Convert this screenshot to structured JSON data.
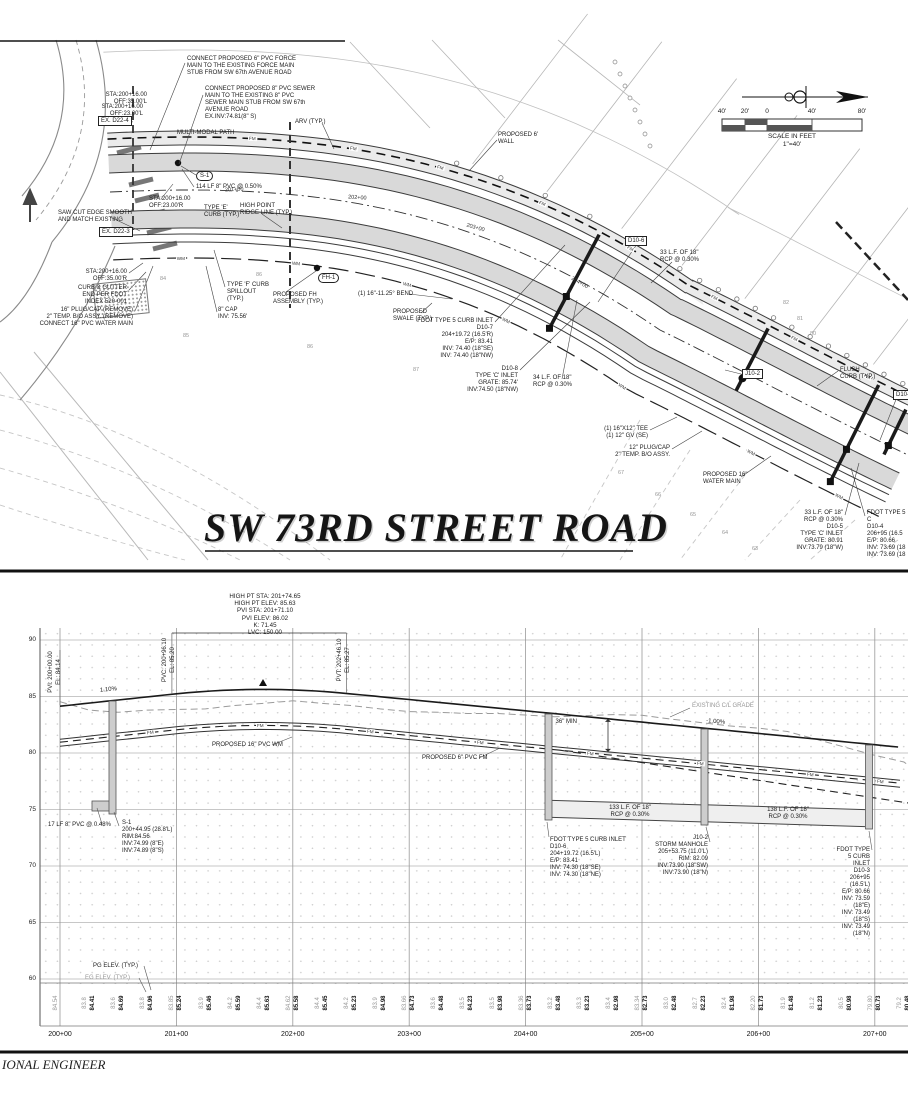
{
  "title": "SW 73RD STREET ROAD",
  "footer": "IONAL ENGINEER",
  "north_scale": {
    "ticks": [
      "40'",
      "20'",
      "0",
      "40'",
      "80'"
    ],
    "tick_x": [
      722,
      745,
      767,
      812,
      862
    ],
    "scale_label": "SCALE IN FEET",
    "scale_ratio": "1\"=40'"
  },
  "plan": {
    "labels": {
      "fm": "FM",
      "wm": "WM"
    },
    "fm_label_x": [
      250,
      340,
      430,
      520,
      600,
      688,
      768,
      842
    ],
    "wm_label_x": [
      180,
      300,
      420,
      540,
      660,
      780,
      868
    ],
    "road_stations": [
      {
        "t": "201+00",
        "x": 225,
        "y": 187,
        "r": -2
      },
      {
        "t": "202+00",
        "x": 348,
        "y": 195,
        "r": 4
      },
      {
        "t": "203+00",
        "x": 466,
        "y": 225,
        "r": 16
      },
      {
        "t": "204+00",
        "x": 570,
        "y": 280,
        "r": 30
      }
    ],
    "contours": [
      {
        "t": "84",
        "x": 160,
        "y": 276
      },
      {
        "t": "86",
        "x": 256,
        "y": 272
      },
      {
        "t": "85",
        "x": 183,
        "y": 333
      },
      {
        "t": "86",
        "x": 307,
        "y": 344
      },
      {
        "t": "87",
        "x": 413,
        "y": 367
      },
      {
        "t": "82",
        "x": 783,
        "y": 300
      },
      {
        "t": "81",
        "x": 797,
        "y": 316
      },
      {
        "t": "80",
        "x": 810,
        "y": 331
      },
      {
        "t": "67",
        "x": 618,
        "y": 470
      },
      {
        "t": "66",
        "x": 655,
        "y": 492
      },
      {
        "t": "65",
        "x": 690,
        "y": 512
      },
      {
        "t": "64",
        "x": 722,
        "y": 530
      },
      {
        "t": "63",
        "x": 752,
        "y": 546
      }
    ],
    "callouts": [
      {
        "n": "connect-force-main",
        "x": 187,
        "y": 56,
        "a": "l",
        "t": "CONNECT PROPOSED 6\" PVC FORCE\nMAIN TO THE EXISTING FORCE MAIN\nSTUB FROM SW 67th AVENUE ROAD"
      },
      {
        "n": "connect-sewer-main",
        "x": 205,
        "y": 86,
        "a": "l",
        "t": "CONNECT PROPOSED 8\" PVC SEWER\nMAIN TO THE EXISTING 8\" PVC\nSEWER MAIN STUB FROM SW 67th\nAVENUE ROAD\nEX.INV:74.81(8\" S)"
      },
      {
        "n": "sta-35l",
        "x": 147,
        "y": 92,
        "a": "r",
        "t": "STA:200+16.00\nOFF:35.00'L"
      },
      {
        "n": "sta-23l",
        "x": 143,
        "y": 104,
        "a": "r",
        "t": "STA:200+16.00\nOFF:23.00'L"
      },
      {
        "n": "ex-d22-4",
        "x": 98,
        "y": 116,
        "a": "l",
        "box": true,
        "t": "EX. D22-4"
      },
      {
        "n": "multi-modal-path",
        "x": 177,
        "y": 130,
        "a": "l",
        "t": "MULTI-MODAL PATH"
      },
      {
        "n": "arv",
        "x": 295,
        "y": 119,
        "a": "l",
        "t": "ARV (TYP.)"
      },
      {
        "n": "s1-bubble",
        "x": 196,
        "y": 171,
        "a": "l",
        "oval": true,
        "t": "S-1"
      },
      {
        "n": "114lf-pvc",
        "x": 196,
        "y": 184,
        "a": "l",
        "t": "114 LF 8\" PVC @ 0.50%"
      },
      {
        "n": "sta-23r",
        "x": 149,
        "y": 196,
        "a": "l",
        "t": "STA:200+16.00\nOFF:23.00'R"
      },
      {
        "n": "type-e-curb",
        "x": 204,
        "y": 205,
        "a": "l",
        "t": "TYPE 'E'\nCURB (TYP.)"
      },
      {
        "n": "high-point-ridge",
        "x": 240,
        "y": 203,
        "a": "l",
        "t": "HIGH POINT\nRIDGE LINE (TYP.)"
      },
      {
        "n": "saw-cut",
        "x": 58,
        "y": 210,
        "a": "l",
        "t": "SAW CUT EDGE SMOOTH\nAND MATCH EXISTING"
      },
      {
        "n": "ex-d22-3",
        "x": 99,
        "y": 227,
        "a": "l",
        "box": true,
        "t": "EX. D22-3"
      },
      {
        "n": "sta-35r",
        "x": 127,
        "y": 269,
        "a": "r",
        "t": "STA:200+16.00\nOFF:35.00'R"
      },
      {
        "n": "curb-gutter-end",
        "x": 127,
        "y": 285,
        "a": "r",
        "t": "CURB & GUTTER\nEND PER FDOT\nINDEX 520-001"
      },
      {
        "n": "plug-cap-16",
        "x": 133,
        "y": 307,
        "a": "r",
        "t": "16\" PLUG/CAP (REMOVE)\n2\" TEMP. B/O ASSY. (REMOVE)\nCONNECT 16\" PVC WATER MAIN"
      },
      {
        "n": "type-f-curb",
        "x": 227,
        "y": 282,
        "a": "l",
        "t": "TYPE 'F' CURB\nSPILLOUT\n(TYP.)"
      },
      {
        "n": "fh-assembly",
        "x": 273,
        "y": 292,
        "a": "l",
        "t": "PROPOSED FH\nASSEMBLY (TYP.)"
      },
      {
        "n": "fh1-bubble",
        "x": 318,
        "y": 273,
        "a": "l",
        "oval": true,
        "t": "FH-1"
      },
      {
        "n": "cap-8",
        "x": 218,
        "y": 307,
        "a": "l",
        "t": "8\" CAP\nINV: 75.56'"
      },
      {
        "n": "bend-16",
        "x": 358,
        "y": 291,
        "a": "l",
        "t": "(1) 16\"-11.25° BEND"
      },
      {
        "n": "swale",
        "x": 393,
        "y": 309,
        "a": "l",
        "t": "PROPOSED\nSWALE (TYP.)"
      },
      {
        "n": "d10-7",
        "x": 493,
        "y": 318,
        "a": "r",
        "t": "FDOT TYPE 5 CURB INLET\nD10-7\n204+19.72 (16.5'R)\nE/P: 83.41\nINV: 74.40 (18\"SE)\nINV: 74.40 (18\"NW)"
      },
      {
        "n": "d10-8",
        "x": 518,
        "y": 366,
        "a": "r",
        "t": "D10-8\nTYPE 'C' INLET\nGRATE: 85.74'\nINV:74.50 (18\"NW)"
      },
      {
        "n": "34lf-rcp",
        "x": 533,
        "y": 375,
        "a": "l",
        "t": "34 L.F. OF 18\"\nRCP @ 0.30%"
      },
      {
        "n": "wall-6ft",
        "x": 498,
        "y": 132,
        "a": "l",
        "t": "PROPOSED 6'\nWALL"
      },
      {
        "n": "d10-6-box",
        "x": 625,
        "y": 236,
        "a": "l",
        "box": true,
        "t": "D10-6"
      },
      {
        "n": "33lf-rcp-a",
        "x": 660,
        "y": 250,
        "a": "l",
        "t": "33 L.F. OF 18\"\nRCP @ 0.30%"
      },
      {
        "n": "j10-2-box",
        "x": 742,
        "y": 369,
        "a": "l",
        "box": true,
        "t": "J10-2"
      },
      {
        "n": "flush-curb",
        "x": 840,
        "y": 367,
        "a": "l",
        "t": "FLUSH\nCURB (TYP.)"
      },
      {
        "n": "d10-3-box",
        "x": 893,
        "y": 390,
        "a": "l",
        "box": true,
        "t": "D10-3"
      },
      {
        "n": "tee-16x12",
        "x": 648,
        "y": 426,
        "a": "r",
        "t": "(1) 16\"X12\" TEE\n(1) 12\" GV (SE)"
      },
      {
        "n": "plug-cap-12",
        "x": 670,
        "y": 445,
        "a": "r",
        "t": "12\" PLUG/CAP\n2\" TEMP. B/O ASSY."
      },
      {
        "n": "water-main-16",
        "x": 703,
        "y": 472,
        "a": "l",
        "t": "PROPOSED 16\"\nWATER MAIN"
      },
      {
        "n": "d10-5",
        "x": 843,
        "y": 510,
        "a": "r",
        "t": "33 L.F. OF 18\"\nRCP @ 0.30%\nD10-5\nTYPE 'C' INLET\nGRATE: 80.91\nINV:73.79 (18\"W)"
      },
      {
        "n": "d10-4",
        "x": 867,
        "y": 510,
        "a": "l",
        "t": "FDOT TYPE 5 C\nD10-4\n206+95 (16.5\nE/P: 80.66\nINV: 73.69 (18\nINV: 73.69 (18"
      }
    ],
    "leaders": [
      [
        185,
        63,
        150,
        150
      ],
      [
        203,
        95,
        179,
        164
      ],
      [
        196,
        175,
        181,
        166
      ],
      [
        194,
        187,
        182,
        169
      ],
      [
        322,
        123,
        334,
        149
      ],
      [
        161,
        199,
        173,
        184
      ],
      [
        262,
        214,
        282,
        228
      ],
      [
        110,
        217,
        140,
        231
      ],
      [
        129,
        273,
        143,
        263
      ],
      [
        129,
        290,
        146,
        272
      ],
      [
        135,
        311,
        153,
        266
      ],
      [
        225,
        287,
        214,
        250
      ],
      [
        286,
        292,
        316,
        271
      ],
      [
        217,
        312,
        206,
        266
      ],
      [
        409,
        294,
        452,
        299
      ],
      [
        421,
        313,
        432,
        303
      ],
      [
        495,
        322,
        565,
        245
      ],
      [
        520,
        370,
        590,
        302
      ],
      [
        562,
        379,
        577,
        300
      ],
      [
        497,
        140,
        469,
        171
      ],
      [
        672,
        262,
        651,
        283
      ],
      [
        838,
        371,
        817,
        386
      ],
      [
        650,
        430,
        677,
        417
      ],
      [
        672,
        449,
        702,
        431
      ],
      [
        741,
        477,
        771,
        456
      ],
      [
        845,
        515,
        859,
        463
      ],
      [
        865,
        516,
        851,
        468
      ],
      [
        637,
        244,
        598,
        302
      ],
      [
        745,
        375,
        725,
        370
      ],
      [
        897,
        397,
        880,
        440
      ],
      [
        121,
        119,
        133,
        122
      ],
      [
        121,
        231,
        133,
        234
      ]
    ]
  },
  "profile": {
    "header": [
      "HIGH PT STA: 201+74.65",
      "HIGH PT ELEV: 85.63",
      "PVI STA: 201+71.10",
      "PVI ELEV: 86.02",
      "K: 71.45",
      "LVC: 150.00"
    ],
    "vtexts": [
      {
        "t": "PVI: 200+00.00",
        "x": 51,
        "y": 672
      },
      {
        "t": "EL: 84.14",
        "x": 59,
        "y": 672
      },
      {
        "t": "PVC: 200+96.10",
        "x": 165,
        "y": 660
      },
      {
        "t": "EL: 85.20",
        "x": 173,
        "y": 660
      },
      {
        "t": "PVT: 202+46.10",
        "x": 340,
        "y": 660
      },
      {
        "t": "EL: 85.27",
        "x": 348,
        "y": 660
      }
    ],
    "slopes": [
      {
        "t": "1.10%",
        "x": 100,
        "y": 687,
        "r": -6
      },
      {
        "t": "-1.00%",
        "x": 706,
        "y": 719,
        "r": 5
      }
    ],
    "labels": {
      "fm": "FM"
    },
    "fm_label_x": [
      150,
      260,
      370,
      480,
      590,
      700,
      810,
      880
    ],
    "callouts": [
      {
        "n": "existing-cl-grade",
        "x": 692,
        "y": 703,
        "a": "l",
        "gray": true,
        "t": "EXISTING C/L GRADE"
      },
      {
        "n": "36in-min",
        "x": 577,
        "y": 719,
        "a": "r",
        "t": "36\" MIN"
      },
      {
        "n": "wm-16-label",
        "x": 212,
        "y": 742,
        "a": "l",
        "t": "PROPOSED 16\" PVC WM"
      },
      {
        "n": "fm-6-label",
        "x": 422,
        "y": 755,
        "a": "l",
        "t": "PROPOSED 6\" PVC FM"
      },
      {
        "n": "17lf-pvc",
        "x": 48,
        "y": 822,
        "a": "l",
        "t": "17 LF 8\" PVC @ 0.48%"
      },
      {
        "n": "s1-profile",
        "x": 122,
        "y": 820,
        "a": "l",
        "t": "S-1\n200+44.95 (28.8'L)\nRIM:84.56\nINV:74.99 (8\"E)\nINV:74.89 (8\"S)"
      },
      {
        "n": "d10-6-profile",
        "x": 550,
        "y": 837,
        "a": "l",
        "t": "FDOT TYPE 5 CURB INLET\nD10-6\n204+19.72 (16.5'L)\nE/P: 83.41\nINV: 74.30 (18\"SE)\nINV: 74.30 (18\"NE)"
      },
      {
        "n": "133lf-rcp",
        "x": 630,
        "y": 805,
        "a": "c",
        "t": "133 L.F. OF 18\"\nRCP @ 0.30%"
      },
      {
        "n": "j10-2-profile",
        "x": 708,
        "y": 835,
        "a": "r",
        "t": "J10-2\nSTORM MANHOLE\n205+53.75 (11.0'L)\nRIM: 82.09\nINV:73.90 (18\"SW)\nINV:73.90 (18\"N)"
      },
      {
        "n": "138lf-rcp",
        "x": 788,
        "y": 807,
        "a": "c",
        "t": "138 L.F. OF 18\"\nRCP @ 0.30%"
      },
      {
        "n": "d10-3-profile",
        "x": 870,
        "y": 847,
        "a": "r",
        "t": "FDOT TYPE 5 CURB INLET\nD10-3\n206+95 (16.5'L)\nE/P: 80.66\nINV: 73.59 (18\"E)\nINV: 73.49 (18\"S)\nINV: 73.49 (18\"N)"
      },
      {
        "n": "pg-elev-label",
        "x": 93,
        "y": 963,
        "a": "l",
        "t": "PG ELEV. (TYP.)"
      },
      {
        "n": "eg-elev-label",
        "x": 85,
        "y": 975,
        "a": "l",
        "gray": true,
        "t": "EG ELEV. (TYP.)"
      }
    ],
    "axis_elevations": [
      "90",
      "85",
      "80",
      "75",
      "70",
      "65",
      "60"
    ],
    "stations": [
      "200+00",
      "201+00",
      "202+00",
      "203+00",
      "204+00",
      "205+00",
      "206+00",
      "207+00"
    ],
    "elev_pairs": [
      [
        0,
        "84.54",
        null
      ],
      [
        25,
        "83.8",
        "84.41"
      ],
      [
        50,
        "83.6",
        "84.69"
      ],
      [
        75,
        "83.8",
        "84.96"
      ],
      [
        100,
        "83.85",
        "85.24"
      ],
      [
        125,
        "83.9",
        "85.46"
      ],
      [
        150,
        "84.2",
        "85.59"
      ],
      [
        175,
        "84.4",
        "85.63"
      ],
      [
        200,
        "84.62",
        "85.58"
      ],
      [
        225,
        "84.4",
        "85.45"
      ],
      [
        250,
        "84.2",
        "85.23"
      ],
      [
        275,
        "83.9",
        "84.98"
      ],
      [
        300,
        "83.66",
        "84.73"
      ],
      [
        325,
        "83.6",
        "84.48"
      ],
      [
        350,
        "83.5",
        "84.23"
      ],
      [
        375,
        "83.5",
        "83.98"
      ],
      [
        400,
        "83.36",
        "83.73"
      ],
      [
        425,
        "83.2",
        "83.48"
      ],
      [
        450,
        "83.3",
        "83.23"
      ],
      [
        475,
        "83.4",
        "82.98"
      ],
      [
        500,
        "83.34",
        "82.73"
      ],
      [
        525,
        "83.0",
        "82.48"
      ],
      [
        550,
        "82.7",
        "82.23"
      ],
      [
        575,
        "82.4",
        "81.98"
      ],
      [
        600,
        "82.20",
        "81.73"
      ],
      [
        625,
        "81.9",
        "81.48"
      ],
      [
        650,
        "81.2",
        "81.23"
      ],
      [
        675,
        "80.5",
        "80.98"
      ],
      [
        700,
        "79.80",
        "80.73"
      ],
      [
        725,
        "79.2",
        "80.48"
      ]
    ]
  }
}
